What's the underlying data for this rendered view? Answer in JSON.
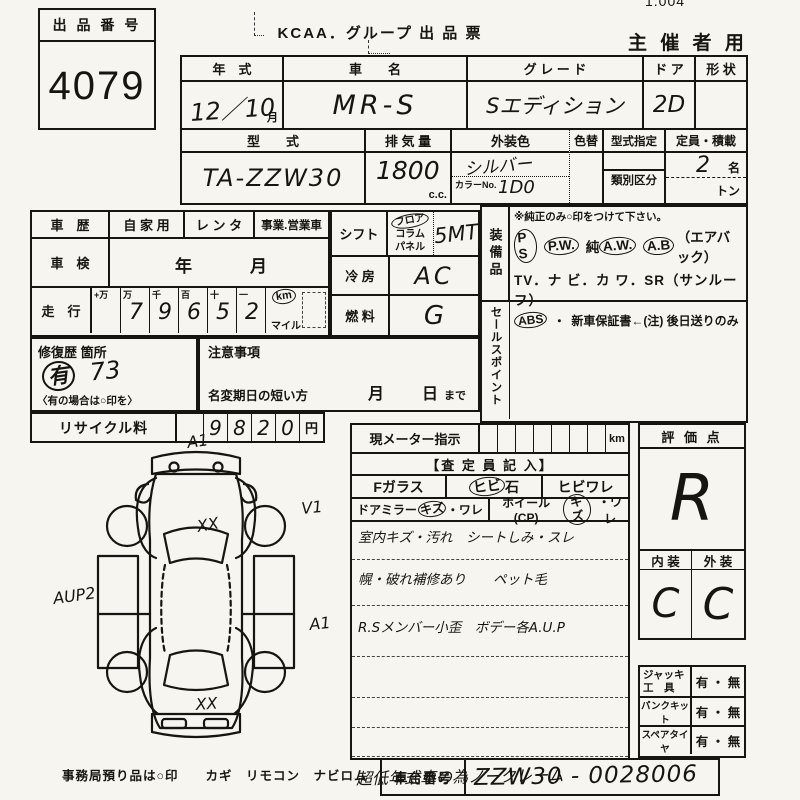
{
  "page": {
    "corner_number": "1.004"
  },
  "header": {
    "lot_label": "出 品 番 号",
    "lot_number": "4079",
    "form_title": "KCAA．グループ 出 品 票",
    "organizer": "主 催 者 用"
  },
  "vehicle": {
    "year_label": "年　式",
    "year_value": "12／10",
    "year_unit": "月",
    "name_label": "車　　名",
    "name_value": "MR-S",
    "grade_label": "グ レ ー ド",
    "grade_value": "Sエディション",
    "door_label": "ド ア",
    "door_value": "2D",
    "shape_label": "形 状",
    "model_label": "型　　式",
    "model_value": "TA-ZZW30",
    "disp_label": "排 気 量",
    "disp_value": "1800",
    "disp_unit": "c.c.",
    "color_label": "外装色",
    "color_value": "シルバー",
    "color_no_label": "カラーNo.",
    "color_no_value": "1D0",
    "recolor_label": "色替",
    "type_desig_label": "型式指定",
    "class_label": "類別区分",
    "capacity_label": "定員・積載",
    "capacity_value": "2",
    "capacity_unit": "名",
    "ton_unit": "トン"
  },
  "history": {
    "history_label": "車　歴",
    "opt_private": "自 家 用",
    "opt_rental": "レ ン タ",
    "opt_business": "事業.営業車",
    "inspection_label": "車　検",
    "inspection_year": "年",
    "inspection_month": "月",
    "mileage_label": "走　行",
    "digit_headers": [
      "+万",
      "万",
      "千",
      "百",
      "十",
      "一"
    ],
    "digits": [
      "",
      "7",
      "9",
      "6",
      "5",
      "2"
    ],
    "unit_km": "km",
    "unit_mile": "マイル",
    "repair_label": "修復歴 箇所",
    "repair_circle": "有",
    "repair_value": "73",
    "repair_hint": "〈有の場合は○印を〉",
    "caution_label": "注意事項",
    "rename_label": "名変期日の短い方",
    "rename_month": "月",
    "rename_day": "日",
    "rename_suffix": "まで",
    "recycle_label": "リサイクル料",
    "recycle_digits": [
      "9",
      "8",
      "2",
      "0"
    ],
    "recycle_unit": "円"
  },
  "spec": {
    "shift_label": "シフト",
    "shift_floor": "フロア",
    "shift_column": "コラム",
    "shift_panel": "パネル",
    "shift_value": "5MT",
    "ac_label": "冷 房",
    "ac_value": "AC",
    "fuel_label": "燃 料",
    "fuel_value": "G"
  },
  "equipment": {
    "label": "装備品",
    "note": "※純正のみ○印をつけて下さい。",
    "ps": "P S",
    "pw": "P.W.",
    "jun": "純",
    "aw": "A.W.",
    "ab": "A.B",
    "ab_suffix": "（エアバック）",
    "line2": "TV．ナ ビ．カ ワ．SR（サンルーフ）",
    "abs": "ABS",
    "sep": "・",
    "warranty": "新車保証書←(注) 後日送りのみ",
    "sales_label": "セールスポイント"
  },
  "assessor": {
    "meter_label": "現メーター指示",
    "meter_unit": "km",
    "header": "【査 定 員 記 入】",
    "fglass_label": "Fガラス",
    "stone_circ": "ヒビ",
    "stone_suffix": "石",
    "crack_label": "ヒビワレ",
    "mirror_label": "ドアミラー",
    "mirror_kizu": "キズ",
    "mirror_suffix": "・ワレ",
    "wheel_label": "ホイール(CP)",
    "wheel_kizu": "キズ",
    "wheel_suffix": "・ワレ",
    "notes": [
      "室内キズ・汚れ　シートしみ・スレ",
      "幌・破れ補修あり　　ペット毛",
      "R.Sメンバー小歪　ボデー各A.U.P"
    ],
    "bottom_note": "超低年式車の為ノークレーム"
  },
  "evaluation": {
    "score_label": "評 価 点",
    "score": "R",
    "interior_label": "内 装",
    "exterior_label": "外 装",
    "interior": "C",
    "exterior": "C",
    "jack_label1": "ジャッキ",
    "jack_label2": "工　具",
    "jack_opts": "有 ・ 無",
    "flat_label": "パンクキット",
    "flat_opts": "有 ・ 無",
    "spare_label": "スペアタイヤ",
    "spare_opts": "有 ・ 無"
  },
  "footer": {
    "chassis_label": "車台番号",
    "chassis_value": "ZZW30 - 0028006",
    "office_note": "事務局預り品は○印　　カギ　リモコン　ナビロム"
  },
  "diagram": {
    "front_mark": "A1",
    "right_front_mark": "V1",
    "hood_mark": "XX",
    "left_mark": "AUP2",
    "right_side_mark": "A1",
    "rear_mark": "XX"
  }
}
